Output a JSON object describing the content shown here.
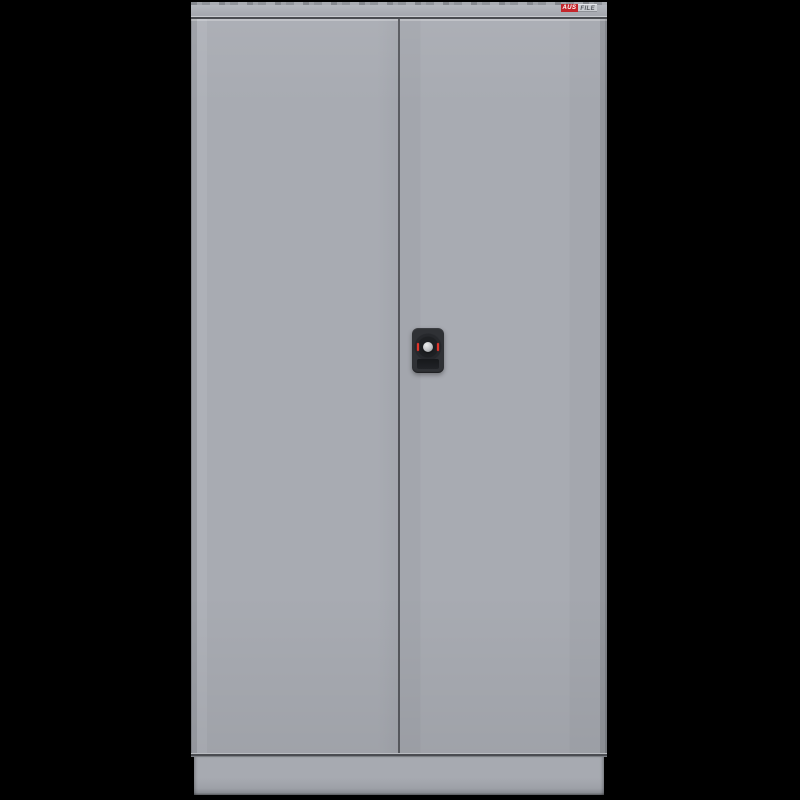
{
  "scene": {
    "type": "product-photo",
    "subject": "Two-door steel stationery cupboard in silver grey, closed doors, front view",
    "background_color": "#000000"
  },
  "colors": {
    "background": "#000000",
    "door-face": "#a8abb2",
    "rail": "#a6a9b0",
    "rail-light": "#b9bcc2",
    "seam": "#4a4c51",
    "plinth": "#a7aab1",
    "brand-red": "#c4262c",
    "brand-silver": "#c9ccd1",
    "lock-body": "#2f3135",
    "lock-button": "#bfc1c4",
    "lock-red": "#e0352b"
  },
  "cabinet": {
    "logo": {
      "prefix": "AUS",
      "suffix": "FILE"
    }
  }
}
